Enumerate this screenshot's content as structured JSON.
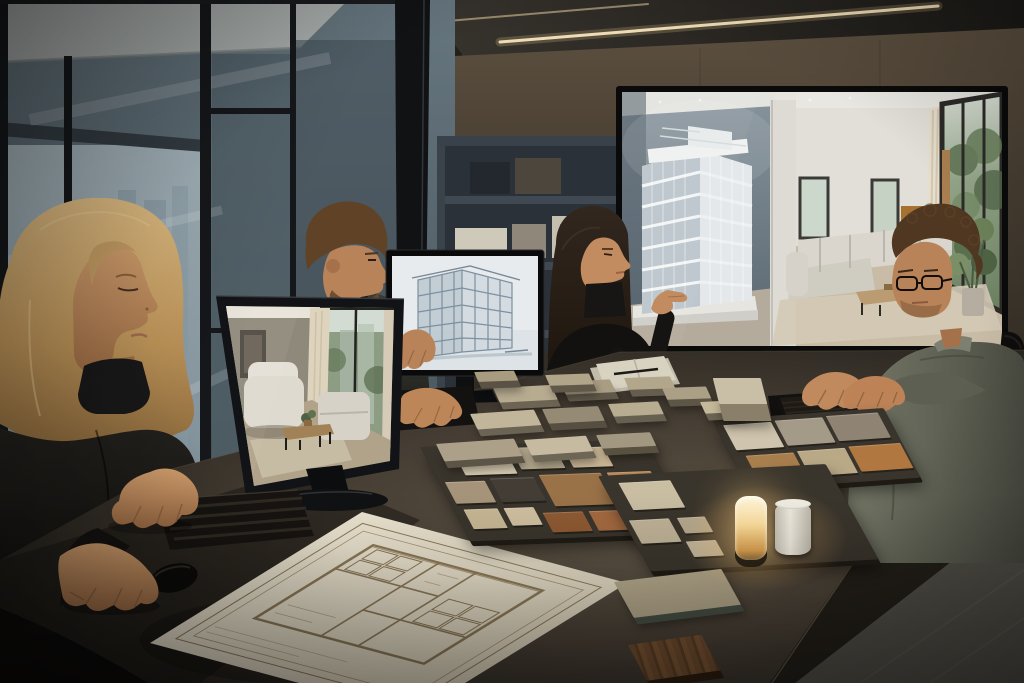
{
  "palette": {
    "ceiling": "#2a2724",
    "wall": "#4a4035",
    "glass": "#5f6f78",
    "glass_bright": "#9aa9b0",
    "mullion": "#15171a",
    "shelf": "#2b3138",
    "screen_bezel": "#0a0a0a",
    "alcove_wall": "#74828c",
    "model_white": "#e4e8ea",
    "interior_white": "#eae7e0",
    "foliage": "#6d8261",
    "sofa": "#d7d3ca",
    "wood": "#b3926b",
    "table": "#4f463a",
    "table_face": "#242019",
    "floor": "#55524a",
    "tray": "#3a352c",
    "paper": "#e9e1cf",
    "plan_ink": "#8b7857",
    "keyboard": "#161310",
    "skin": "#c08a5f",
    "skin_shadow": "#875c3e",
    "hair_blonde": "#c9a26b",
    "hair_dark": "#241c17",
    "hair_brown": "#5d4026",
    "hair_curl": "#4a3322",
    "sweater": "#676a5c",
    "black_clothing": "#131211",
    "led_warm": "#f6e4bd",
    "lamp_glow": "#f7d492",
    "credenza": "#211e1a"
  },
  "samples": {
    "trays": [
      {
        "name": "swatch-board-main",
        "x": 420,
        "y": 447,
        "w": 225,
        "h": 96,
        "skew": 26,
        "rot": -2,
        "swatches": [
          {
            "x": 30,
            "y": 6,
            "w": 52,
            "h": 24,
            "color": "#d6cab0"
          },
          {
            "x": 88,
            "y": 4,
            "w": 44,
            "h": 22,
            "color": "#b2a68c"
          },
          {
            "x": 140,
            "y": 6,
            "w": 40,
            "h": 20,
            "color": "#c9b694"
          },
          {
            "x": 6,
            "y": 36,
            "w": 40,
            "h": 22,
            "color": "#a6947a"
          },
          {
            "x": 52,
            "y": 34,
            "w": 44,
            "h": 24,
            "color": "#433d36"
          },
          {
            "x": 102,
            "y": 32,
            "w": 62,
            "h": 32,
            "color": "#9a7248"
          },
          {
            "x": 170,
            "y": 32,
            "w": 44,
            "h": 26,
            "color": "#b98a58"
          },
          {
            "x": 10,
            "y": 64,
            "w": 34,
            "h": 20,
            "color": "#c7b794"
          },
          {
            "x": 50,
            "y": 64,
            "w": 30,
            "h": 18,
            "color": "#cfc0a0"
          },
          {
            "x": 86,
            "y": 70,
            "w": 40,
            "h": 20,
            "color": "#8e5a33"
          },
          {
            "x": 132,
            "y": 70,
            "w": 46,
            "h": 20,
            "color": "#a46a40"
          }
        ]
      },
      {
        "name": "swatch-board-right",
        "x": 712,
        "y": 420,
        "w": 172,
        "h": 72,
        "skew": 24,
        "rot": -4,
        "swatches": [
          {
            "x": 8,
            "y": 6,
            "w": 48,
            "h": 26,
            "color": "#cfc4ae"
          },
          {
            "x": 60,
            "y": 5,
            "w": 48,
            "h": 26,
            "color": "#a49a88"
          },
          {
            "x": 112,
            "y": 4,
            "w": 52,
            "h": 26,
            "color": "#8f8374"
          },
          {
            "x": 14,
            "y": 38,
            "w": 48,
            "h": 26,
            "color": "#a87e4e"
          },
          {
            "x": 66,
            "y": 37,
            "w": 48,
            "h": 26,
            "color": "#b9a987"
          },
          {
            "x": 118,
            "y": 36,
            "w": 52,
            "h": 26,
            "color": "#b07740"
          }
        ]
      },
      {
        "name": "lamp-board",
        "x": 598,
        "y": 476,
        "w": 228,
        "h": 98,
        "skew": 26,
        "rot": -3,
        "swatches": [
          {
            "x": 16,
            "y": 8,
            "w": 52,
            "h": 28,
            "color": "#c9bda2"
          },
          {
            "x": 6,
            "y": 46,
            "w": 40,
            "h": 24,
            "color": "#bfb297"
          },
          {
            "x": 54,
            "y": 46,
            "w": 28,
            "h": 16,
            "color": "#b5a98e"
          },
          {
            "x": 50,
            "y": 70,
            "w": 30,
            "h": 16,
            "color": "#c2b69b"
          }
        ]
      }
    ],
    "blocks": [
      {
        "x": 493,
        "y": 388,
        "w": 58,
        "h": 15,
        "color": "#b7ab90",
        "side": "#6d6454",
        "rot": -3
      },
      {
        "x": 560,
        "y": 382,
        "w": 50,
        "h": 13,
        "color": "#a99d83",
        "side": "#5f584a",
        "rot": -3
      },
      {
        "x": 624,
        "y": 378,
        "w": 46,
        "h": 12,
        "color": "#b3a78b",
        "side": "#655e4f",
        "rot": -2
      },
      {
        "x": 470,
        "y": 414,
        "w": 64,
        "h": 16,
        "color": "#c2b69a",
        "side": "#6b6354",
        "rot": -4
      },
      {
        "x": 542,
        "y": 409,
        "w": 56,
        "h": 15,
        "color": "#958a73",
        "side": "#554e41",
        "rot": -3
      },
      {
        "x": 608,
        "y": 404,
        "w": 50,
        "h": 13,
        "color": "#b9ad91",
        "side": "#675f50",
        "rot": -3
      },
      {
        "x": 436,
        "y": 444,
        "w": 78,
        "h": 18,
        "color": "#aca188",
        "side": "#5c5547",
        "rot": -4
      },
      {
        "x": 524,
        "y": 440,
        "w": 62,
        "h": 16,
        "color": "#c6baa0",
        "side": "#6d6556",
        "rot": -4
      },
      {
        "x": 596,
        "y": 435,
        "w": 54,
        "h": 14,
        "color": "#a29780",
        "side": "#58513f",
        "rot": -3
      },
      {
        "x": 662,
        "y": 388,
        "w": 44,
        "h": 12,
        "color": "#ab9f85",
        "side": "#5d5647",
        "rot": -2
      },
      {
        "x": 700,
        "y": 402,
        "w": 40,
        "h": 12,
        "color": "#c5b999",
        "side": "#6b6452",
        "rot": -3
      },
      {
        "x": 545,
        "y": 375,
        "w": 44,
        "h": 11,
        "color": "#b0a489",
        "side": "#60594a",
        "rot": -2
      },
      {
        "x": 474,
        "y": 372,
        "w": 40,
        "h": 10,
        "color": "#a79b80",
        "side": "#5a5345",
        "rot": -2
      },
      {
        "x": 614,
        "y": 582,
        "w": 108,
        "h": 38,
        "color": "#b2a68a",
        "side": "#474f44",
        "rot": -7
      }
    ],
    "cube": {
      "x": 716,
      "y": 378,
      "w": 48,
      "h": 26,
      "color": "#c9bfa6",
      "side": "#8a8069"
    },
    "lamp": {
      "x": 735,
      "y": 496,
      "w": 32,
      "h": 64,
      "glow": "#ffdf9e",
      "core": "#fff3d2",
      "base": "#2b2317"
    },
    "cylinder": {
      "x": 775,
      "y": 503,
      "w": 36,
      "h": 52
    },
    "wood_sample": {
      "x": 628,
      "y": 645,
      "w": 74,
      "h": 38,
      "rot": -8
    }
  }
}
